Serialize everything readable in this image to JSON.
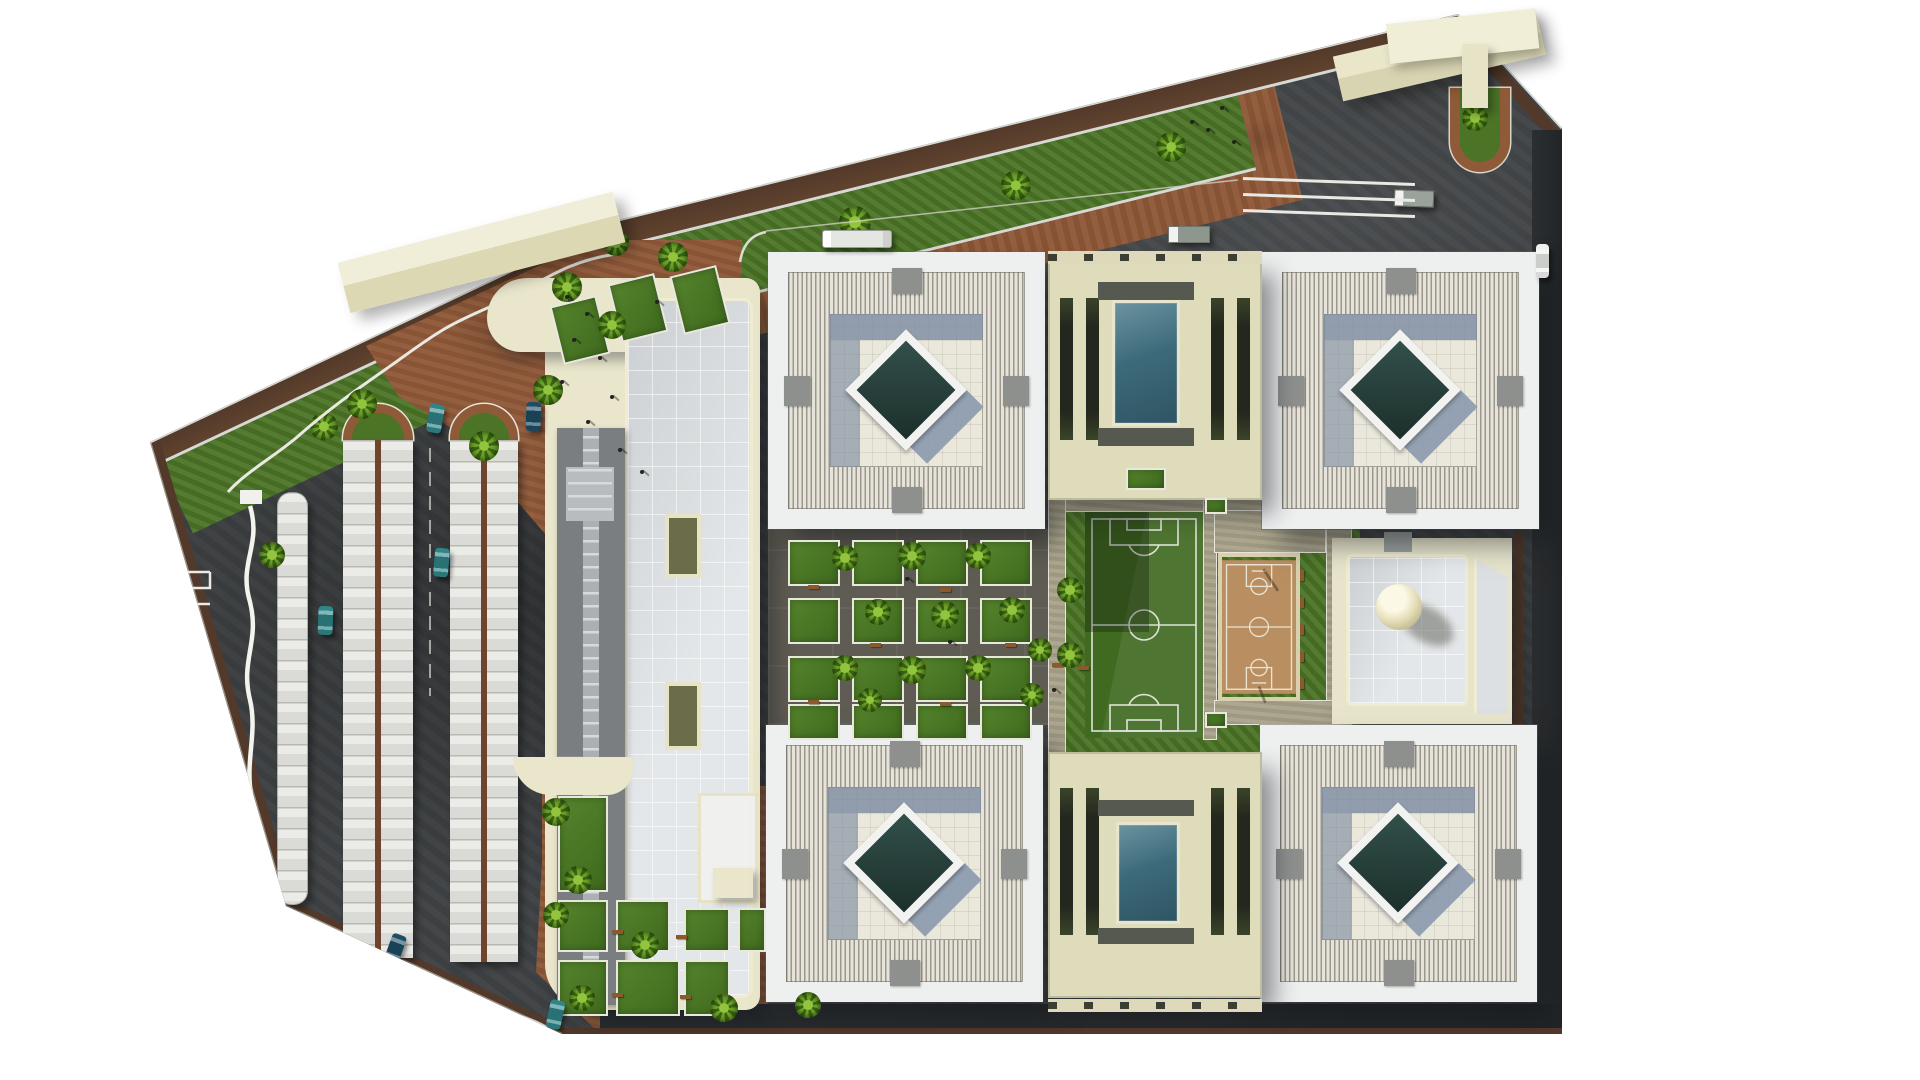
{
  "meta": {
    "kind": "architectural-site-plan-aerial-render",
    "visible_text": "none",
    "description": "Top-down 3D rendering of a campus/school site: four square courtyard towers with diamond skylights, two glass-roof halls, central gardens, soccer field, basketball court, dome building, large hall with ramp, shaded parking rows, palm trees, perimeter lawns and roads"
  },
  "palette": {
    "asphalt": "#3f4244",
    "asphalt_dark": "#222527",
    "terra": "#8d5737",
    "terra_dark": "#7a4b2d",
    "grass": "#4b7426",
    "cream": "#e9e6cc",
    "white_roof": "#eef0f0",
    "louver_light": "#e6e3da",
    "louver_dark": "#9c978b",
    "tab_gray": "#8e908e",
    "floor": "#eae7db",
    "shadow_blue": "#8a99ad",
    "diamond_dark": "#1c2f2b",
    "diamond_mid": "#32504a",
    "hall_cream": "#dfdcbc",
    "slot_dark": "#24271d",
    "glass_teal": "#3d6a7a",
    "glass_teal_light": "#6b93a0",
    "cap_gray": "#565950",
    "khaki": "#a8a189",
    "field_green": "#3f6a20",
    "court_tan": "#b98e60",
    "line_white": "#e9e6d8",
    "curb": "#e9e9e2",
    "brown_edge": "#53392a",
    "teal_car": "#2f8588",
    "navy_car": "#1f4d66",
    "white_car": "#eff1ef",
    "ramp_gray": "#7b7e81",
    "ramp_light": "#aab0b4",
    "dome_cream": "#efe9c8"
  },
  "towers": {
    "count": 4,
    "size": 277,
    "positions": [
      [
        768,
        252
      ],
      [
        1262,
        252
      ],
      [
        766,
        725
      ],
      [
        1260,
        725
      ]
    ]
  },
  "halls": {
    "count": 2,
    "list": [
      {
        "x": 1048,
        "y": 256,
        "w": 214,
        "h": 244,
        "glass": [
          64,
          44,
          68,
          126
        ],
        "caps": [
          [
            50,
            26,
            96,
            18
          ],
          [
            50,
            172,
            96,
            18
          ]
        ],
        "slots": {
          "y": 42,
          "h": 142,
          "xs": [
            12,
            38,
            163,
            189
          ],
          "w": 13
        }
      },
      {
        "x": 1048,
        "y": 752,
        "w": 214,
        "h": 246,
        "glass": [
          68,
          70,
          64,
          102
        ],
        "caps": [
          [
            50,
            48,
            96,
            16
          ],
          [
            50,
            176,
            96,
            16
          ]
        ],
        "slots": {
          "y": 36,
          "h": 147,
          "xs": [
            12,
            38,
            163,
            189
          ],
          "w": 13
        }
      }
    ]
  },
  "dentil_bands": [
    [
      1048,
      251
    ],
    [
      1048,
      999
    ]
  ],
  "sports": {
    "field": {
      "x": 1085,
      "y": 512,
      "w": 118,
      "h": 226,
      "color": "#3f6a20",
      "lines": "#dfe3da"
    },
    "court": {
      "x": 1218,
      "y": 553,
      "w": 82,
      "h": 148,
      "color": "#b98e60",
      "lines": "#e9e4d2"
    },
    "bench_strip": {
      "x": 1304,
      "y": 556,
      "w": 22,
      "h": 132
    }
  },
  "landscape": {
    "trees": [
      [
        567,
        287,
        30
      ],
      [
        612,
        325,
        28
      ],
      [
        616,
        243,
        26
      ],
      [
        673,
        257,
        30
      ],
      [
        548,
        390,
        30
      ],
      [
        362,
        404,
        30
      ],
      [
        484,
        446,
        30
      ],
      [
        272,
        555,
        26
      ],
      [
        1475,
        118,
        26
      ],
      [
        556,
        812,
        28
      ],
      [
        578,
        880,
        28
      ],
      [
        556,
        915,
        26
      ],
      [
        645,
        945,
        28
      ],
      [
        582,
        998,
        26
      ],
      [
        724,
        1008,
        28
      ],
      [
        808,
        1005,
        26
      ],
      [
        845,
        558,
        26
      ],
      [
        912,
        556,
        28
      ],
      [
        978,
        556,
        26
      ],
      [
        878,
        612,
        26
      ],
      [
        945,
        615,
        28
      ],
      [
        1012,
        610,
        26
      ],
      [
        845,
        668,
        26
      ],
      [
        912,
        670,
        28
      ],
      [
        978,
        668,
        26
      ],
      [
        1040,
        650,
        24
      ],
      [
        1032,
        695,
        24
      ],
      [
        870,
        700,
        24
      ],
      [
        1070,
        590,
        26
      ],
      [
        1070,
        655,
        26
      ]
    ],
    "plots_central_grid": {
      "cols": [
        788,
        852,
        916,
        980
      ],
      "rows": [
        540,
        598,
        656
      ],
      "w": 52,
      "h": 46,
      "row4_y": 704,
      "row4_h": 36
    },
    "plots_extra": [
      [
        1126,
        468,
        40,
        22
      ],
      [
        1205,
        498,
        22,
        16
      ],
      [
        1205,
        712,
        22,
        16
      ]
    ],
    "plots_bottom_left": [
      [
        558,
        796,
        50,
        96
      ],
      [
        558,
        900,
        50,
        52
      ],
      [
        616,
        900,
        54,
        52
      ],
      [
        558,
        960,
        50,
        56
      ],
      [
        616,
        960,
        64,
        56
      ],
      [
        684,
        908,
        46,
        44
      ],
      [
        684,
        960,
        46,
        56
      ],
      [
        738,
        908,
        28,
        44
      ]
    ],
    "plots_tilted_top": {
      "positions": [
        [
          556,
          300
        ],
        [
          614,
          278
        ],
        [
          676,
          270
        ]
      ],
      "w": 48,
      "h": 60,
      "rot": -14
    },
    "benches_garden": [
      [
        808,
        585
      ],
      [
        940,
        588
      ],
      [
        870,
        643
      ],
      [
        1005,
        643
      ],
      [
        808,
        700
      ],
      [
        940,
        702
      ],
      [
        612,
        930
      ],
      [
        676,
        935
      ],
      [
        612,
        993
      ],
      [
        680,
        995
      ],
      [
        1052,
        663
      ],
      [
        1078,
        666
      ]
    ],
    "benches_court": [
      [
        1300,
        570
      ],
      [
        1300,
        597
      ],
      [
        1300,
        624
      ],
      [
        1300,
        651
      ],
      [
        1300,
        678
      ]
    ],
    "people": [
      [
        565,
        295
      ],
      [
        585,
        312
      ],
      [
        572,
        338
      ],
      [
        598,
        356
      ],
      [
        560,
        380
      ],
      [
        610,
        395
      ],
      [
        586,
        420
      ],
      [
        618,
        448
      ],
      [
        640,
        470
      ],
      [
        655,
        300
      ],
      [
        905,
        577
      ],
      [
        948,
        640
      ],
      [
        1052,
        688
      ],
      [
        1190,
        120
      ],
      [
        1206,
        128
      ],
      [
        1220,
        106
      ],
      [
        1232,
        140
      ]
    ]
  },
  "vehicles": {
    "cars": [
      {
        "x": 428,
        "y": 404,
        "color": "teal",
        "rot": 10
      },
      {
        "x": 526,
        "y": 402,
        "color": "navy",
        "rot": 2
      },
      {
        "x": 434,
        "y": 548,
        "color": "teal",
        "rot": 5
      },
      {
        "x": 318,
        "y": 606,
        "color": "teal",
        "rot": 2
      },
      {
        "x": 388,
        "y": 934,
        "color": "navy",
        "rot": 20
      },
      {
        "x": 548,
        "y": 1000,
        "color": "teal",
        "rot": 12
      },
      {
        "x": 1536,
        "y": 244,
        "color": "white",
        "rot": 0,
        "w": 13,
        "h": 34
      }
    ],
    "bus": {
      "x": 822,
      "y": 230,
      "w": 70,
      "h": 18
    },
    "trucks": [
      {
        "x": 1168,
        "y": 226,
        "w": 42,
        "h": 17,
        "c": "#8e978d",
        "rot": 0
      },
      {
        "x": 1394,
        "y": 190,
        "w": 40,
        "h": 17,
        "c": "#9aa39b",
        "rot": 2
      }
    ]
  },
  "parking": {
    "strips": [
      {
        "type": "single",
        "x": 277,
        "y": 492,
        "w": 31,
        "h": 413
      },
      {
        "type": "double",
        "x": 343,
        "y": 440,
        "w": 70,
        "h": 518,
        "arch": [
          343,
          404,
          70,
          36
        ]
      },
      {
        "type": "double",
        "x": 450,
        "y": 440,
        "w": 68,
        "h": 522,
        "arch": [
          450,
          404,
          68,
          36
        ]
      }
    ],
    "ne_stripes": {
      "x": 1243,
      "ys": [
        180,
        196,
        212
      ],
      "w": 172
    }
  },
  "counts": {
    "courtyard_towers": 4,
    "glass_halls": 2,
    "parking_canopy_rows": 3,
    "palm_trees": 30
  }
}
